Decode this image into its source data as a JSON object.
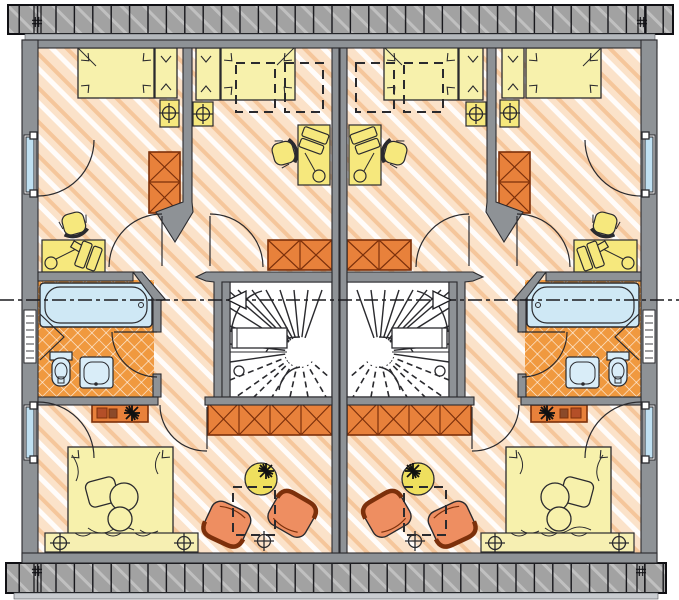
{
  "plan": {
    "kind": "duplex-upper-floor-plan",
    "units": [
      "left-unit",
      "right-unit"
    ],
    "mirrored": true,
    "rooms_per_unit": [
      "bedroom-top-outer",
      "bedroom-top-inner",
      "bathroom",
      "stair-hall",
      "bedroom-bottom"
    ],
    "fixtures": [
      "bathtub",
      "toilet",
      "washbasin",
      "radiator-window",
      "winder-staircase"
    ],
    "furniture": [
      "single-bed",
      "double-bed",
      "desk",
      "desk-lamp",
      "monitor",
      "desk-chair",
      "nightstand",
      "wardrobe",
      "sideboard",
      "armchair",
      "round-table",
      "bed-bench",
      "wall-shelf"
    ],
    "symbols": [
      "section-dash-line",
      "section-arrow",
      "door-swing-arc",
      "skylight-dashed-outline",
      "ceiling-lamp-cross",
      "plant-star",
      "roof-eave-hatch",
      "eave-joint-hash"
    ]
  },
  "palette": {
    "wall": "#8e9296",
    "wallLight": "#b4b8bc",
    "line": "#2a2a2e",
    "eaveBase": "#a2a2a2",
    "floorBase": "#fbe2c9",
    "floorWhite": "#ffffff",
    "floorOrange": "#f5c69b",
    "tile": "#f0993f",
    "tileLine": "#ffffff",
    "yellow": "#f6e87d",
    "paleYellow": "#f7f1ac",
    "benchYellow": "#f6efb2",
    "orange": "#e8813b",
    "orangeLine": "#7c300b",
    "chairOrange": "#ee8e61",
    "tableYellow": "#efdf5e",
    "fixtureBlue": "#d9edf8",
    "tubBlue": "#cfe8f5",
    "glass": "#bfe0f2",
    "shelfItem": "#b44f28"
  }
}
